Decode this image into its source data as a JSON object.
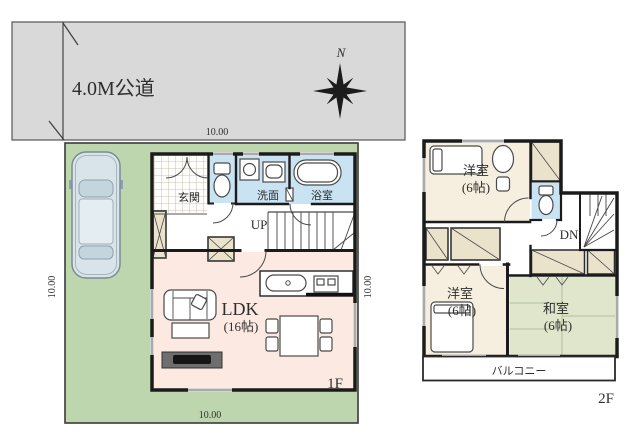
{
  "site": {
    "road_label": "4.0M公道",
    "north_label": "N",
    "dim_top": "10.00",
    "dim_bottom": "10.00",
    "dim_left": "10.00",
    "dim_right": "10.00"
  },
  "floor1": {
    "floor_label": "1F",
    "entrance": "玄関",
    "washroom": "洗面",
    "bathroom": "浴室",
    "stairs": "UP",
    "ldk": "LDK",
    "ldk_size": "(16帖)"
  },
  "floor2": {
    "floor_label": "2F",
    "bedroom1": "洋室",
    "bedroom1_size": "(6帖)",
    "bedroom2": "洋室",
    "bedroom2_size": "(6帖)",
    "japanese_room": "和室",
    "japanese_room_size": "(6帖)",
    "stairs": "DN",
    "balcony": "バルコニー"
  },
  "colors": {
    "road": "#d9d9d9",
    "plot_green": "#bed6ae",
    "water_blue": "#c9e3f2",
    "ldk_pink": "#fceae2",
    "room_cream": "#f6efdf",
    "tatami_green": "#dfe6cb",
    "closet_beige": "#ebe2cb",
    "wall_black": "#1b1b1b",
    "car_body": "#d8e4ea"
  }
}
